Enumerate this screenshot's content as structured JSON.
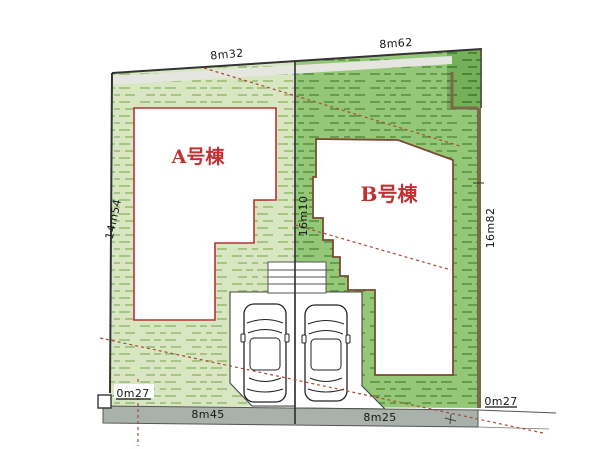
{
  "plan": {
    "type": "residential-lot-site-plan",
    "buildings": {
      "a_label": "A号棟",
      "b_label": "B号棟"
    },
    "dimensions": {
      "top_left_edge": "8m32",
      "top_right_edge": "8m62",
      "left_edge": "14m54",
      "center_line": "16m10",
      "right_edge": "16m82",
      "bottom_left_corner": "0m27",
      "bottom_road_left": "8m45",
      "bottom_road_right": "8m25",
      "bottom_right_corner": "0m27"
    },
    "colors": {
      "grass_light": "#d8e7c2",
      "grass_mid": "#95c779",
      "grass_dark": "#74b059",
      "road_gray": "#a9b2aa",
      "building_a_outline": "#b53333",
      "building_b_outline": "#7d4a33",
      "boundary_brown": "#7b6a4a",
      "building_label_red": "#c23131",
      "dashed_line_red": "#a84b3a"
    }
  }
}
